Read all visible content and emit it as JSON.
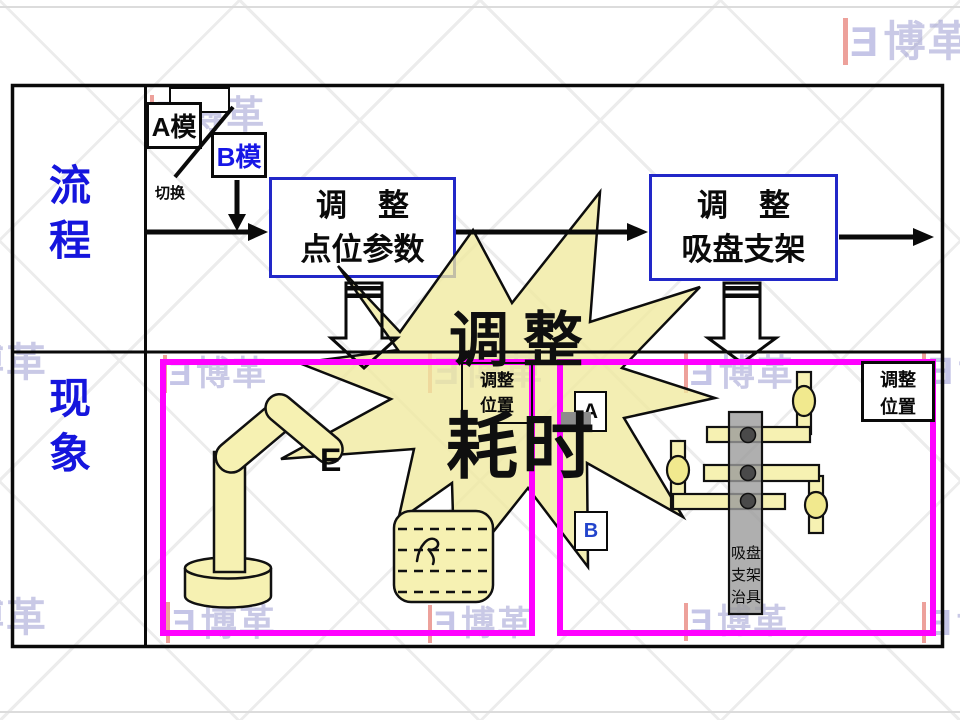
{
  "slide": {
    "rows": [
      {
        "label": "流程"
      },
      {
        "label": "现象"
      }
    ],
    "mode": {
      "a": "A模",
      "b": "B模",
      "switch_label": "切换"
    },
    "steps": [
      {
        "line1": "调　整",
        "line2": "点位参数"
      },
      {
        "line1": "调　整",
        "line2": "吸盘支架"
      }
    ],
    "burst": {
      "line1": "调整",
      "line2": "耗时"
    },
    "callout_left": {
      "line1": "调整",
      "line2": "位置"
    },
    "callout_right": {
      "line1": "调整",
      "line2": "位置"
    },
    "markers": {
      "a": "A",
      "b": "B",
      "effector": "E"
    },
    "jig": {
      "line1": "吸盘",
      "line2": "支架",
      "line3": "治具"
    },
    "colors": {
      "label_blue": "#1515dd",
      "step_border_blue": "#2228c8",
      "highlight_magenta": "#ff00ff",
      "burst_fill": "#f0e99e",
      "shape_fill": "#f6f1b2",
      "column_gray": "#9b9b9b"
    }
  },
  "watermark": {
    "mark": "Ǝ",
    "text": "博革"
  }
}
